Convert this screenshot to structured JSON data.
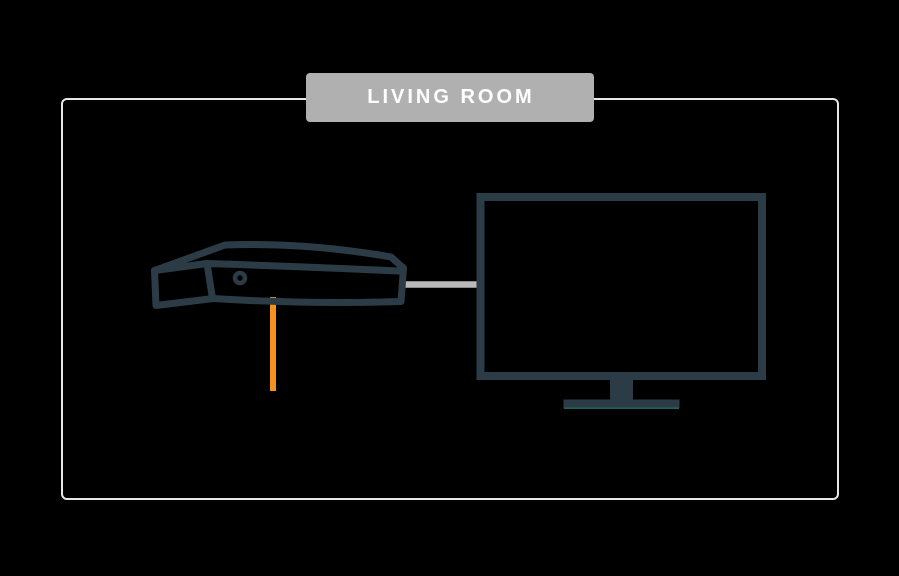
{
  "room": {
    "label": "LIVING ROOM"
  },
  "devices": {
    "set_top_box": "set-top-box-icon",
    "tv": "tv-icon",
    "hdmi_cable": "hdmi-cable-icon",
    "coax_cable": "coax-cable-icon"
  },
  "colors": {
    "background": "#000000",
    "room_border": "#E6E6E6",
    "label_bg": "#B0B0B0",
    "label_text": "#FFFFFF",
    "device_outline": "#2B3C46",
    "hdmi_cable": "#B9B9B9",
    "coax_cable": "#F5921E",
    "stand_accent": "#24605C"
  }
}
